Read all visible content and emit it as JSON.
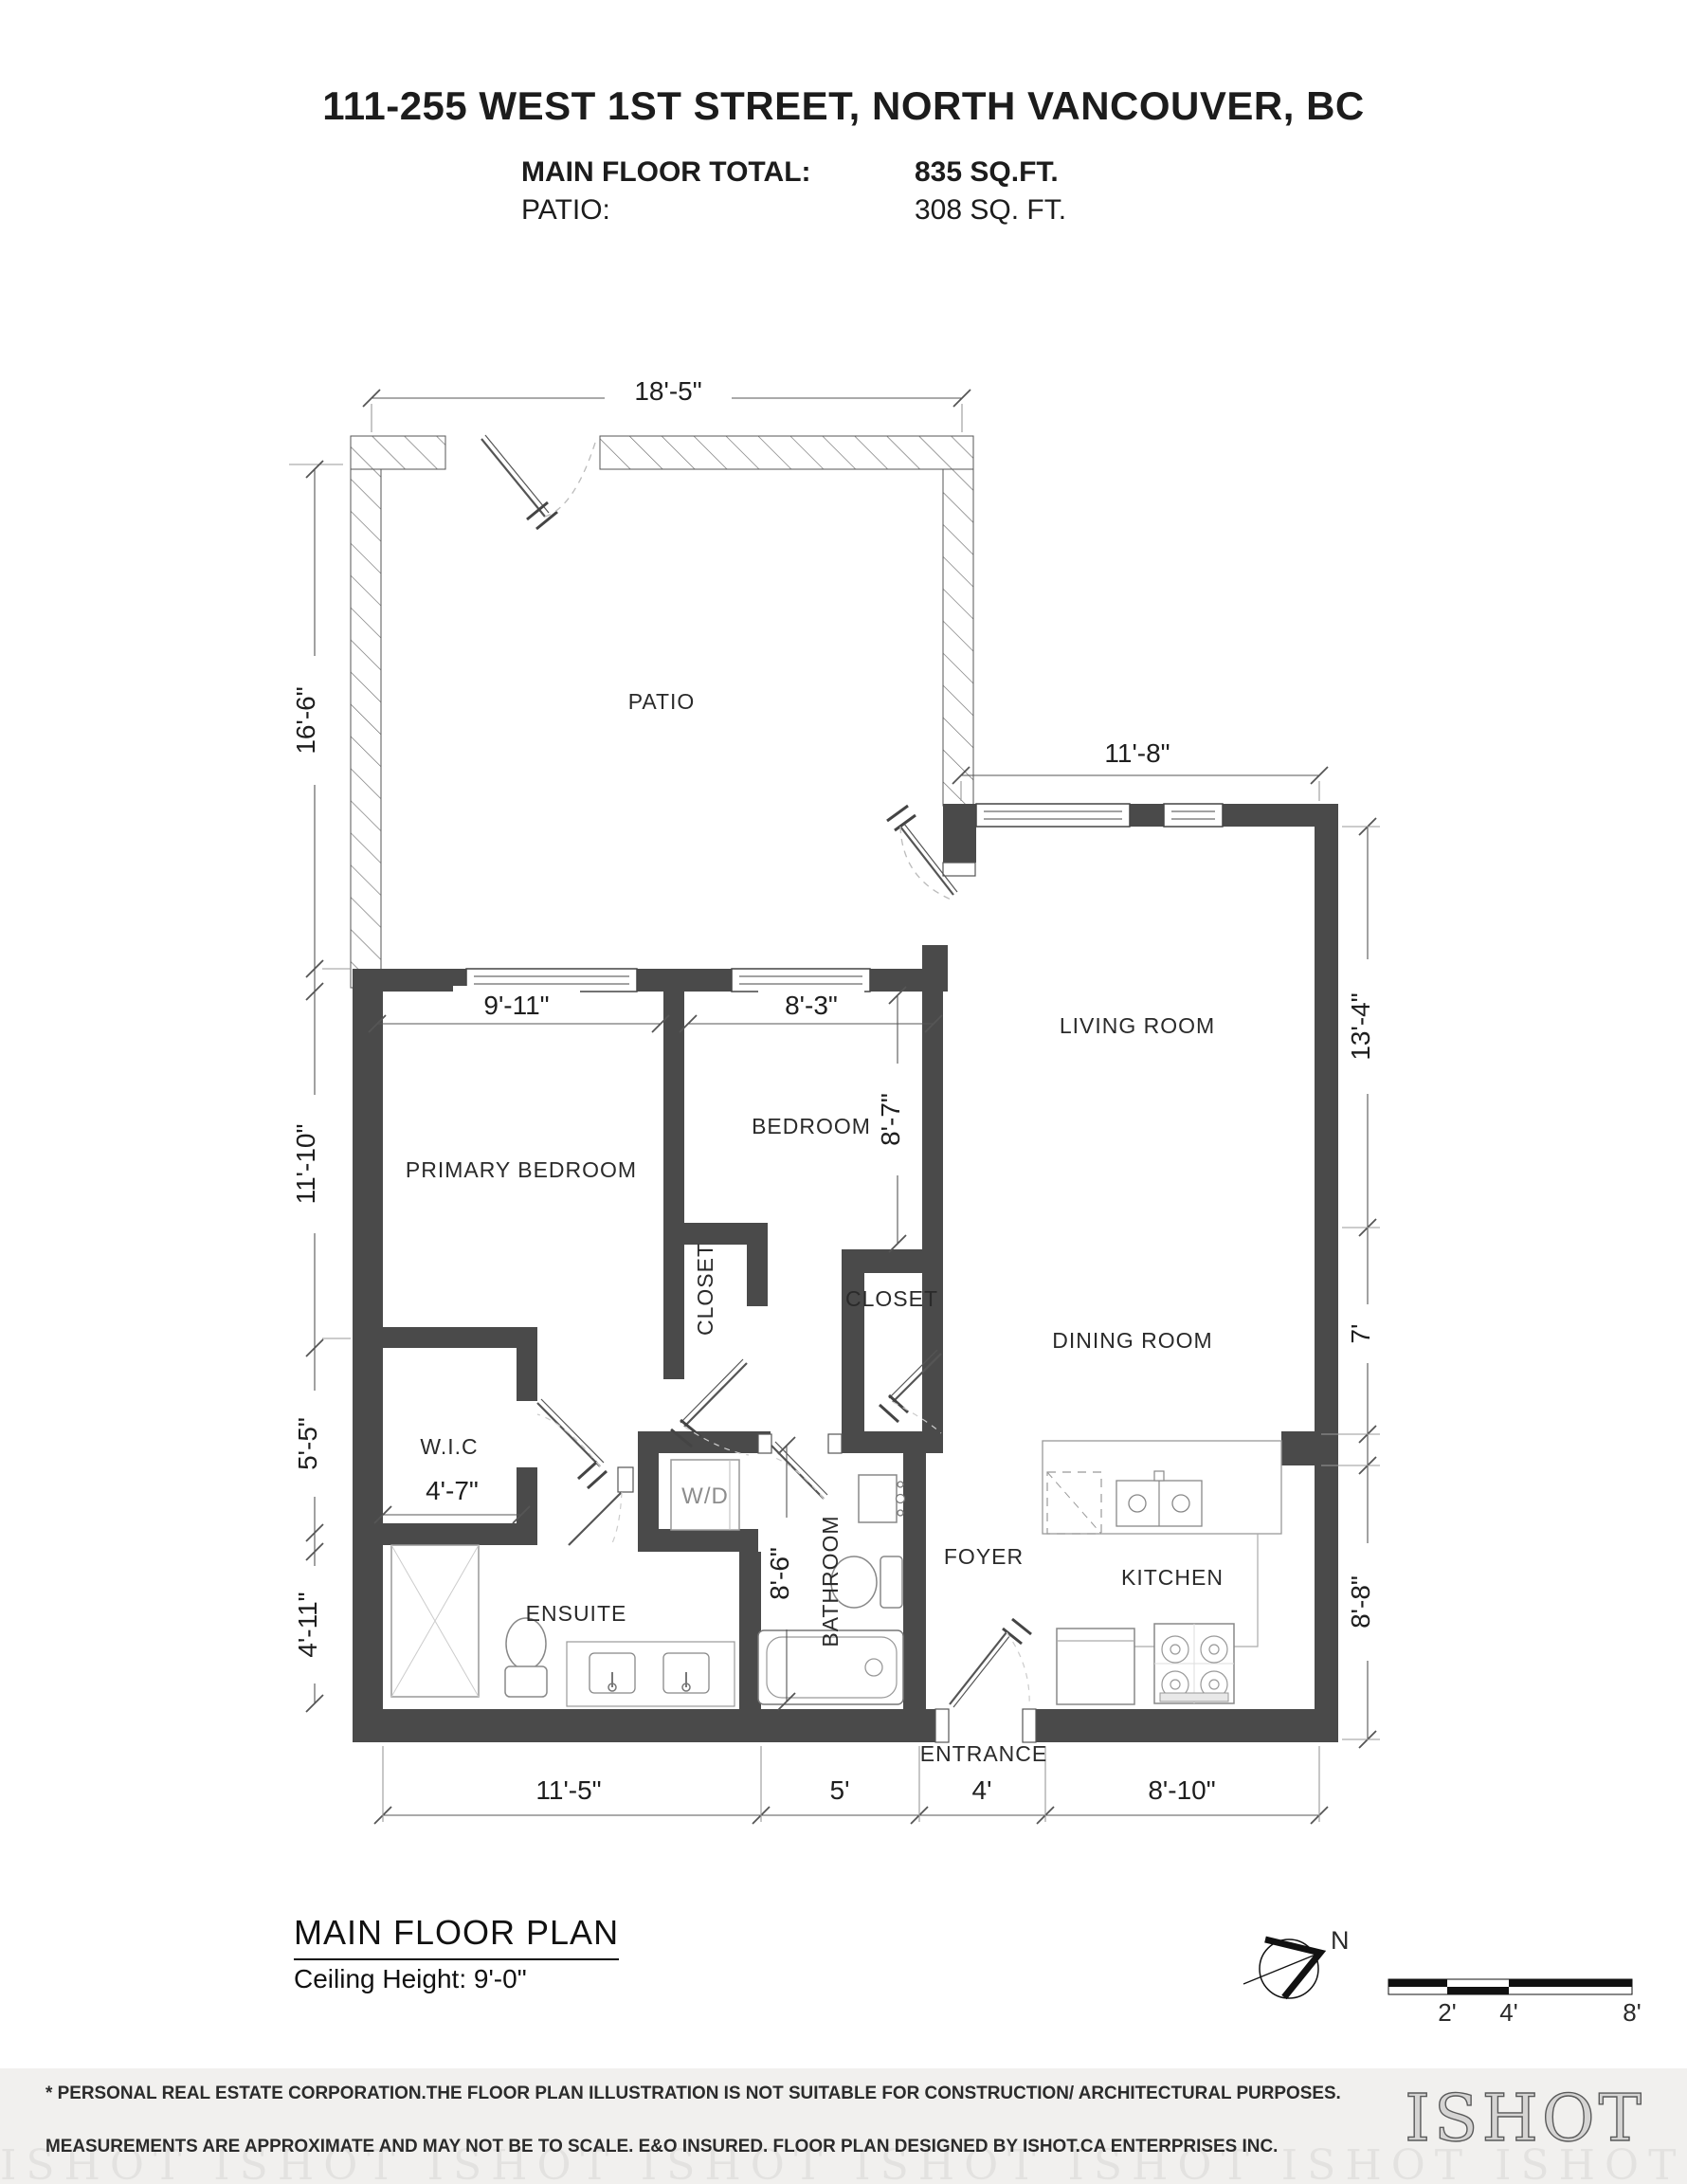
{
  "header": {
    "title": "111-255 WEST 1ST STREET, NORTH VANCOUVER, BC",
    "main_floor_label": "MAIN FLOOR TOTAL:",
    "main_floor_value": "835 SQ.FT.",
    "patio_label": "PATIO:",
    "patio_value": "308 SQ. FT."
  },
  "rooms": {
    "patio": "PATIO",
    "living": "LIVING ROOM",
    "primary": "PRIMARY BEDROOM",
    "bedroom": "BEDROOM",
    "closet1": "CLOSET",
    "closet2": "CLOSET",
    "dining": "DINING ROOM",
    "wic": "W.I.C",
    "wd": "W/D",
    "bathroom": "BATHROOM",
    "foyer": "FOYER",
    "kitchen": "KITCHEN",
    "ensuite": "ENSUITE",
    "entrance": "ENTRANCE"
  },
  "dims": {
    "patio_width": "18'-5\"",
    "patio_height": "16'-6\"",
    "living_width": "11'-8\"",
    "primary_width": "9'-11\"",
    "bedroom_width": "8'-3\"",
    "bedroom_height": "8'-7\"",
    "primary_height": "11'-10\"",
    "living_height": "13'-4\"",
    "dining_height": "7'",
    "kitchen_height": "8'-8\"",
    "wic_height": "5'-5\"",
    "wic_width": "4'-7\"",
    "ensuite_height": "4'-11\"",
    "bathroom_height": "8'-6\"",
    "bottom_left": "11'-5\"",
    "bottom_bath": "5'",
    "bottom_entry": "4'",
    "bottom_kitchen": "8'-10\""
  },
  "title_block": {
    "title": "MAIN FLOOR PLAN",
    "ceiling": "Ceiling Height: 9'-0\""
  },
  "compass": {
    "north_label": "N"
  },
  "scale_bar": {
    "tick1": "2'",
    "tick2": "4'",
    "tick3": "8'"
  },
  "footer": {
    "line1": "* PERSONAL REAL ESTATE CORPORATION.THE FLOOR PLAN ILLUSTRATION IS NOT SUITABLE FOR CONSTRUCTION/ ARCHITECTURAL PURPOSES.",
    "line2": "MEASUREMENTS ARE APPROXIMATE AND MAY NOT BE TO SCALE. E&O INSURED. FLOOR PLAN DESIGNED BY ISHOT.CA ENTERPRISES INC.",
    "line3": "604-368-7979  ISHOT.CA",
    "logo": "ISHOT"
  }
}
